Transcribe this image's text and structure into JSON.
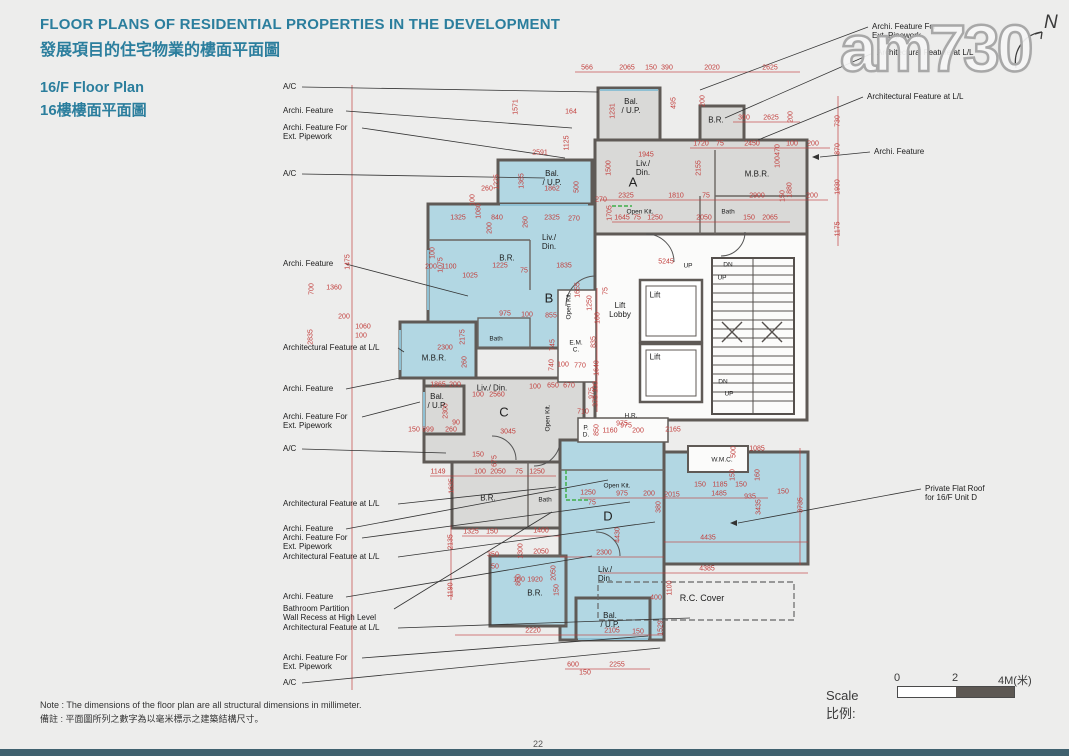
{
  "header": {
    "title_en": "FLOOR PLANS OF RESIDENTIAL PROPERTIES IN THE DEVELOPMENT",
    "title_zh": "發展項目的住宅物業的樓面平面圖",
    "subtitle_en": "16/F Floor Plan",
    "subtitle_zh": "16樓樓面平面圖"
  },
  "watermark": "am730",
  "north_label": "N",
  "scale": {
    "label": "Scale 比例:",
    "ticks": [
      "0",
      "2",
      "4M(米)"
    ]
  },
  "note": {
    "en": "Note :  The dimensions of the floor plan are all structural dimensions in millimeter.",
    "zh": "備註 :  平面圖所列之數字為以毫米標示之建築結構尺寸。"
  },
  "page_number": "22",
  "plan": {
    "unit_letters": [
      {
        "t": "A",
        "x": 633,
        "y": 182
      },
      {
        "t": "B",
        "x": 549,
        "y": 298
      },
      {
        "t": "C",
        "x": 504,
        "y": 412
      },
      {
        "t": "D",
        "x": 608,
        "y": 516
      }
    ],
    "rooms": [
      {
        "lines": [
          "Bal.",
          "/ U.P."
        ],
        "x": 631,
        "y": 106
      },
      {
        "lines": [
          "B.R."
        ],
        "x": 716,
        "y": 120
      },
      {
        "lines": [
          "Liv./",
          "Din."
        ],
        "x": 643,
        "y": 168
      },
      {
        "lines": [
          "M.B.R."
        ],
        "x": 757,
        "y": 174
      },
      {
        "lines": [
          "Open Kit."
        ],
        "x": 640,
        "y": 212,
        "cls": "s"
      },
      {
        "lines": [
          "Bath"
        ],
        "x": 728,
        "y": 212,
        "cls": "s"
      },
      {
        "lines": [
          "Bal.",
          "/ U.P."
        ],
        "x": 552,
        "y": 178
      },
      {
        "lines": [
          "Liv./",
          "Din."
        ],
        "x": 549,
        "y": 242
      },
      {
        "lines": [
          "B.R."
        ],
        "x": 507,
        "y": 258
      },
      {
        "lines": [
          "M.B.R."
        ],
        "x": 434,
        "y": 358
      },
      {
        "lines": [
          "Bath"
        ],
        "x": 496,
        "y": 339,
        "cls": "s"
      },
      {
        "lines": [
          "Open Kit."
        ],
        "x": 569,
        "y": 306,
        "cls": "s v"
      },
      {
        "lines": [
          "Lift",
          "Lobby"
        ],
        "x": 620,
        "y": 310
      },
      {
        "lines": [
          "Lift"
        ],
        "x": 655,
        "y": 295
      },
      {
        "lines": [
          "Lift"
        ],
        "x": 655,
        "y": 357
      },
      {
        "lines": [
          "E.M.",
          "C."
        ],
        "x": 576,
        "y": 347,
        "cls": "s"
      },
      {
        "lines": [
          "H.R."
        ],
        "x": 631,
        "y": 416,
        "cls": "s"
      },
      {
        "lines": [
          "P.",
          "D."
        ],
        "x": 586,
        "y": 432,
        "cls": "s"
      },
      {
        "lines": [
          "Bal.",
          "/ U.P."
        ],
        "x": 437,
        "y": 401
      },
      {
        "lines": [
          "Liv./ Din."
        ],
        "x": 492,
        "y": 388
      },
      {
        "lines": [
          "B.R."
        ],
        "x": 488,
        "y": 498
      },
      {
        "lines": [
          "Bath"
        ],
        "x": 545,
        "y": 500,
        "cls": "s"
      },
      {
        "lines": [
          "Open Kit."
        ],
        "x": 548,
        "y": 418,
        "cls": "s v"
      },
      {
        "lines": [
          "W.M.C."
        ],
        "x": 722,
        "y": 460,
        "cls": "s"
      },
      {
        "lines": [
          "Open Kit."
        ],
        "x": 617,
        "y": 486,
        "cls": "s"
      },
      {
        "lines": [
          "Liv./",
          "Din."
        ],
        "x": 605,
        "y": 574
      },
      {
        "lines": [
          "B.R."
        ],
        "x": 535,
        "y": 593
      },
      {
        "lines": [
          "Bal.",
          "/ U.P."
        ],
        "x": 610,
        "y": 620
      },
      {
        "lines": [
          "R.C. Cover"
        ],
        "x": 702,
        "y": 598,
        "cls": "m"
      },
      {
        "lines": [
          "UP"
        ],
        "x": 688,
        "y": 266,
        "cls": "s"
      },
      {
        "lines": [
          "DN"
        ],
        "x": 728,
        "y": 265,
        "cls": "s"
      },
      {
        "lines": [
          "UP"
        ],
        "x": 722,
        "y": 278,
        "cls": "s"
      },
      {
        "lines": [
          "DN"
        ],
        "x": 723,
        "y": 382,
        "cls": "s"
      },
      {
        "lines": [
          "UP"
        ],
        "x": 729,
        "y": 394,
        "cls": "s"
      }
    ],
    "dimensions": [
      [
        "566",
        587,
        68
      ],
      [
        "2065",
        627,
        68
      ],
      [
        "150",
        651,
        68
      ],
      [
        "390",
        667,
        68
      ],
      [
        "2020",
        712,
        68
      ],
      [
        "2625",
        770,
        68
      ],
      [
        "1571",
        516,
        107,
        1
      ],
      [
        "164",
        571,
        112
      ],
      [
        "1125",
        567,
        143,
        1
      ],
      [
        "2591",
        540,
        153
      ],
      [
        "1231",
        613,
        111,
        1
      ],
      [
        "495",
        674,
        103,
        1
      ],
      [
        "200",
        703,
        101,
        1
      ],
      [
        "1862",
        552,
        189
      ],
      [
        "500",
        577,
        187,
        1
      ],
      [
        "300",
        744,
        118
      ],
      [
        "2625",
        771,
        118
      ],
      [
        "200",
        791,
        117,
        1
      ],
      [
        "730",
        838,
        121,
        1
      ],
      [
        "870",
        838,
        149,
        1
      ],
      [
        "1930",
        838,
        187,
        1
      ],
      [
        "1175",
        838,
        229,
        1
      ],
      [
        "1945",
        646,
        155
      ],
      [
        "1720",
        701,
        144
      ],
      [
        "75",
        720,
        144
      ],
      [
        "2450",
        752,
        144
      ],
      [
        "100",
        792,
        144
      ],
      [
        "200",
        813,
        144
      ],
      [
        "1500",
        609,
        168,
        1
      ],
      [
        "2155",
        699,
        168,
        1
      ],
      [
        "470",
        778,
        150,
        1
      ],
      [
        "100",
        778,
        162,
        1
      ],
      [
        "1880",
        790,
        190,
        1
      ],
      [
        "2325",
        626,
        196
      ],
      [
        "1810",
        676,
        196
      ],
      [
        "75",
        706,
        196
      ],
      [
        "2900",
        757,
        196
      ],
      [
        "150",
        783,
        196,
        1
      ],
      [
        "200",
        812,
        196
      ],
      [
        "270",
        601,
        200
      ],
      [
        "1705",
        610,
        213,
        1
      ],
      [
        "1645",
        622,
        218
      ],
      [
        "75",
        637,
        218
      ],
      [
        "1250",
        655,
        218
      ],
      [
        "2050",
        704,
        218
      ],
      [
        "150",
        749,
        218
      ],
      [
        "2065",
        770,
        218
      ],
      [
        "5245",
        666,
        262
      ],
      [
        "1225",
        497,
        182,
        1
      ],
      [
        "1365",
        522,
        181,
        1
      ],
      [
        "260",
        487,
        189
      ],
      [
        "100",
        473,
        200,
        1
      ],
      [
        "1080",
        479,
        211,
        1
      ],
      [
        "1325",
        458,
        218
      ],
      [
        "840",
        497,
        218
      ],
      [
        "260",
        526,
        222,
        1
      ],
      [
        "2325",
        552,
        218
      ],
      [
        "270",
        574,
        219
      ],
      [
        "200",
        490,
        228,
        1
      ],
      [
        "100",
        433,
        253,
        1
      ],
      [
        "1075",
        441,
        265,
        1
      ],
      [
        "200",
        431,
        267
      ],
      [
        "1100",
        449,
        267
      ],
      [
        "1225",
        500,
        266
      ],
      [
        "75",
        524,
        271
      ],
      [
        "1835",
        564,
        266
      ],
      [
        "1025",
        470,
        276
      ],
      [
        "1655",
        578,
        290,
        1
      ],
      [
        "975",
        505,
        314
      ],
      [
        "100",
        527,
        315
      ],
      [
        "855",
        551,
        316
      ],
      [
        "1475",
        348,
        262,
        1
      ],
      [
        "700",
        312,
        289,
        1
      ],
      [
        "1360",
        334,
        288
      ],
      [
        "200",
        344,
        317
      ],
      [
        "2835",
        311,
        337,
        1
      ],
      [
        "1060",
        363,
        327
      ],
      [
        "100",
        361,
        336
      ],
      [
        "2175",
        463,
        337,
        1
      ],
      [
        "2300",
        445,
        348
      ],
      [
        "260",
        465,
        362,
        1
      ],
      [
        "1250",
        590,
        303,
        1
      ],
      [
        "75",
        606,
        291,
        1
      ],
      [
        "100",
        598,
        318,
        1
      ],
      [
        "835",
        594,
        342,
        1
      ],
      [
        "745",
        553,
        345,
        1
      ],
      [
        "740",
        552,
        365,
        1
      ],
      [
        "100",
        563,
        365
      ],
      [
        "770",
        580,
        366
      ],
      [
        "1640",
        597,
        368,
        1
      ],
      [
        "100",
        596,
        387,
        1
      ],
      [
        "375",
        596,
        401,
        1
      ],
      [
        "710",
        583,
        412
      ],
      [
        "975",
        626,
        426
      ],
      [
        "1865",
        438,
        385
      ],
      [
        "200",
        455,
        385
      ],
      [
        "100",
        478,
        395
      ],
      [
        "2560",
        497,
        395
      ],
      [
        "2300",
        446,
        411,
        1
      ],
      [
        "90",
        456,
        423
      ],
      [
        "260",
        451,
        430
      ],
      [
        "150",
        414,
        430
      ],
      [
        "999",
        428,
        430
      ],
      [
        "3045",
        508,
        432
      ],
      [
        "100",
        535,
        387
      ],
      [
        "650",
        553,
        386
      ],
      [
        "670",
        569,
        386
      ],
      [
        "975",
        592,
        393,
        1
      ],
      [
        "850",
        597,
        430,
        1
      ],
      [
        "1160",
        610,
        431
      ],
      [
        "200",
        638,
        431
      ],
      [
        "2165",
        673,
        430
      ],
      [
        "975",
        622,
        424
      ],
      [
        "1149",
        438,
        472
      ],
      [
        "100",
        480,
        472
      ],
      [
        "2050",
        498,
        472
      ],
      [
        "75",
        519,
        472
      ],
      [
        "1250",
        537,
        472
      ],
      [
        "150",
        478,
        455
      ],
      [
        "675",
        495,
        461,
        1
      ],
      [
        "1635",
        452,
        486,
        1
      ],
      [
        "1325",
        471,
        532
      ],
      [
        "150",
        492,
        532
      ],
      [
        "1400",
        541,
        531
      ],
      [
        "2135",
        451,
        542,
        1
      ],
      [
        "350",
        493,
        555
      ],
      [
        "50",
        495,
        567
      ],
      [
        "2050",
        541,
        552
      ],
      [
        "1300",
        521,
        551,
        1
      ],
      [
        "800",
        519,
        580,
        1
      ],
      [
        "1190",
        451,
        590,
        1
      ],
      [
        "1085",
        757,
        449
      ],
      [
        "500",
        734,
        452,
        1
      ],
      [
        "150",
        733,
        475,
        1
      ],
      [
        "160",
        758,
        475,
        1
      ],
      [
        "150",
        700,
        485
      ],
      [
        "1185",
        720,
        485
      ],
      [
        "150",
        741,
        485
      ],
      [
        "1485",
        719,
        494
      ],
      [
        "935",
        750,
        497
      ],
      [
        "150",
        783,
        492
      ],
      [
        "3735",
        801,
        505,
        1
      ],
      [
        "3435",
        759,
        507,
        1
      ],
      [
        "2015",
        672,
        495
      ],
      [
        "200",
        649,
        494
      ],
      [
        "1250",
        588,
        493
      ],
      [
        "975",
        622,
        494
      ],
      [
        "75",
        592,
        503
      ],
      [
        "380",
        659,
        507,
        1
      ],
      [
        "4435",
        708,
        538
      ],
      [
        "4385",
        707,
        569
      ],
      [
        "2300",
        604,
        553
      ],
      [
        "4430",
        618,
        535,
        1
      ],
      [
        "1100",
        670,
        588,
        1
      ],
      [
        "400",
        656,
        598
      ],
      [
        "1920",
        535,
        580
      ],
      [
        "100",
        519,
        580
      ],
      [
        "2050",
        554,
        573,
        1
      ],
      [
        "150",
        557,
        590,
        1
      ],
      [
        "2220",
        533,
        631
      ],
      [
        "1529",
        661,
        628,
        1
      ],
      [
        "2105",
        612,
        631
      ],
      [
        "150",
        638,
        632
      ],
      [
        "600",
        573,
        665
      ],
      [
        "150",
        585,
        673
      ],
      [
        "2255",
        617,
        665
      ]
    ],
    "callouts_left": [
      {
        "lines": [
          "A/C"
        ],
        "y": 87,
        "lx": 302,
        "t": [
          598,
          92
        ]
      },
      {
        "lines": [
          "Archi. Feature"
        ],
        "y": 111,
        "lx": 346,
        "t": [
          572,
          128
        ]
      },
      {
        "lines": [
          "Archi. Feature For",
          "Ext. Pipework"
        ],
        "y": 128,
        "lx": 362,
        "t": [
          565,
          158
        ]
      },
      {
        "lines": [
          "A/C"
        ],
        "y": 174,
        "lx": 302,
        "t": [
          545,
          178
        ]
      },
      {
        "lines": [
          "Archi. Feature"
        ],
        "y": 264,
        "lx": 346,
        "t": [
          468,
          296
        ]
      },
      {
        "lines": [
          "Architectural Feature at L/L"
        ],
        "y": 348,
        "lx": 398,
        "t": [
          404,
          352
        ]
      },
      {
        "lines": [
          "Archi. Feature"
        ],
        "y": 389,
        "lx": 346,
        "t": [
          400,
          378
        ]
      },
      {
        "lines": [
          "Archi. Feature For",
          "Ext. Pipework"
        ],
        "y": 417,
        "lx": 362,
        "t": [
          420,
          402
        ]
      },
      {
        "lines": [
          "A/C"
        ],
        "y": 449,
        "lx": 302,
        "t": [
          446,
          453
        ]
      },
      {
        "lines": [
          "Architectural Feature at L/L"
        ],
        "y": 504,
        "lx": 398,
        "t": [
          556,
          487
        ]
      },
      {
        "lines": [
          "Archi. Feature"
        ],
        "y": 529,
        "lx": 346,
        "t": [
          608,
          480
        ]
      },
      {
        "lines": [
          "Archi. Feature For",
          "Ext. Pipework"
        ],
        "y": 538,
        "lx": 362,
        "t": [
          630,
          502
        ]
      },
      {
        "lines": [
          "Architectural Feature at L/L"
        ],
        "y": 557,
        "lx": 398,
        "t": [
          655,
          522
        ]
      },
      {
        "lines": [
          "Archi. Feature"
        ],
        "y": 597,
        "lx": 346,
        "t": [
          592,
          556
        ]
      },
      {
        "lines": [
          "Bathroom Partition",
          "Wall Recess at High Level"
        ],
        "y": 609,
        "lx": 394,
        "t": [
          552,
          512
        ]
      },
      {
        "lines": [
          "Architectural Feature at L/L"
        ],
        "y": 628,
        "lx": 398,
        "t": [
          690,
          618
        ]
      },
      {
        "lines": [
          "Archi. Feature For",
          "Ext. Pipework"
        ],
        "y": 658,
        "lx": 362,
        "t": [
          648,
          636
        ]
      },
      {
        "lines": [
          "A/C"
        ],
        "y": 683,
        "lx": 302,
        "t": [
          660,
          648
        ]
      }
    ],
    "callouts_right": [
      {
        "lines": [
          "Archi. Feature For",
          "Ext. Pipework"
        ],
        "x": 872,
        "y": 27,
        "t": [
          700,
          90
        ]
      },
      {
        "lines": [
          "Architectural Feature at L/L"
        ],
        "x": 877,
        "y": 53,
        "t": [
          725,
          118
        ]
      },
      {
        "lines": [
          "Architectural Feature at L/L"
        ],
        "x": 867,
        "y": 97,
        "t": [
          758,
          140
        ]
      },
      {
        "lines": [
          "Archi. Feature"
        ],
        "x": 874,
        "y": 152,
        "t": [
          812,
          157
        ],
        "arrow": true
      },
      {
        "lines": [
          "Private Flat Roof",
          "for 16/F Unit D"
        ],
        "x": 925,
        "y": 489,
        "t": [
          730,
          523
        ],
        "arrow": true
      }
    ]
  }
}
